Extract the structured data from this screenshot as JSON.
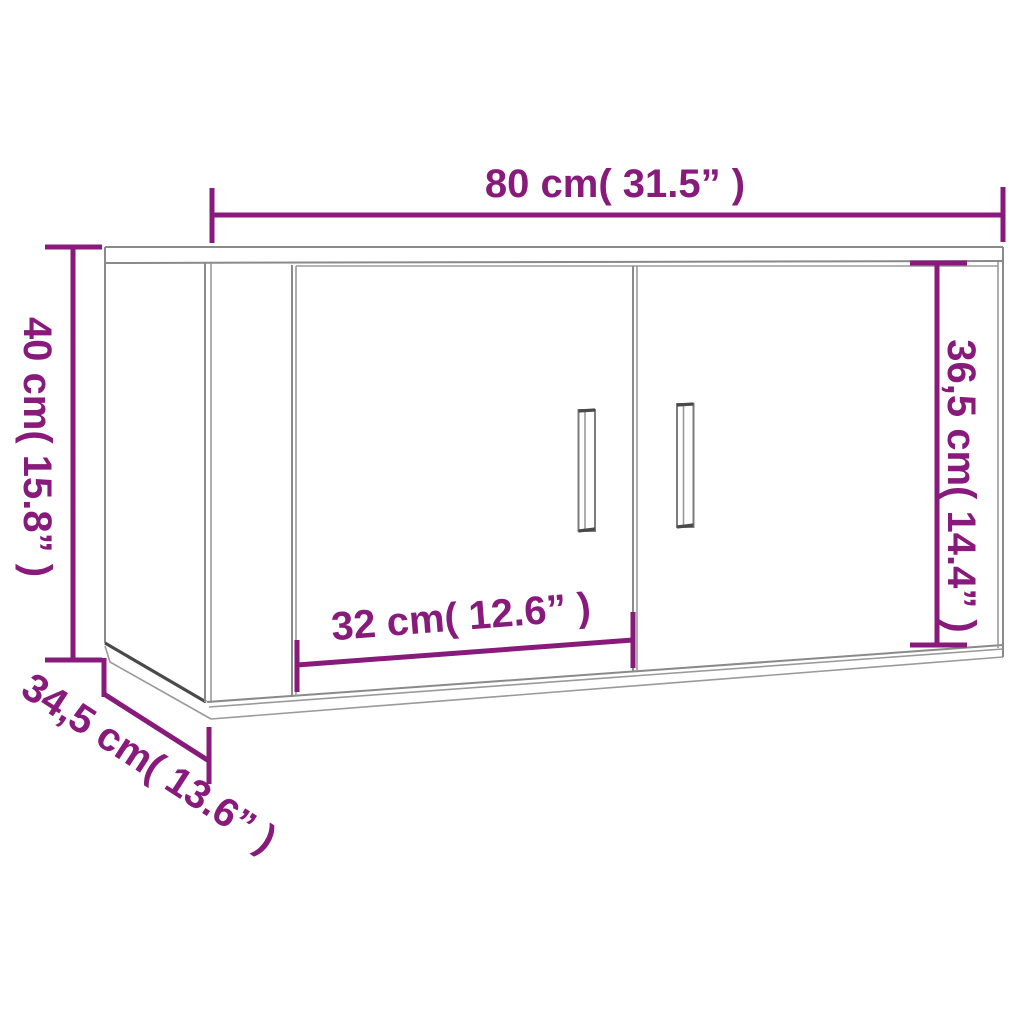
{
  "title": "Wall-mounted cabinet dimension diagram",
  "colors": {
    "dimension_accent": "#871a7a",
    "cabinet_outline": "#8a8a8a",
    "cabinet_dark_edge": "#4a4a4a",
    "background": "#ffffff"
  },
  "dimensions": {
    "width_label": "80 cm( 31.5” )",
    "height_label": "40 cm( 15.8” )",
    "front_height_label": "36,5 cm( 14.4” )",
    "door_width_label": "32 cm( 12.6” )",
    "depth_label": "34,5 cm( 13.6” )"
  }
}
